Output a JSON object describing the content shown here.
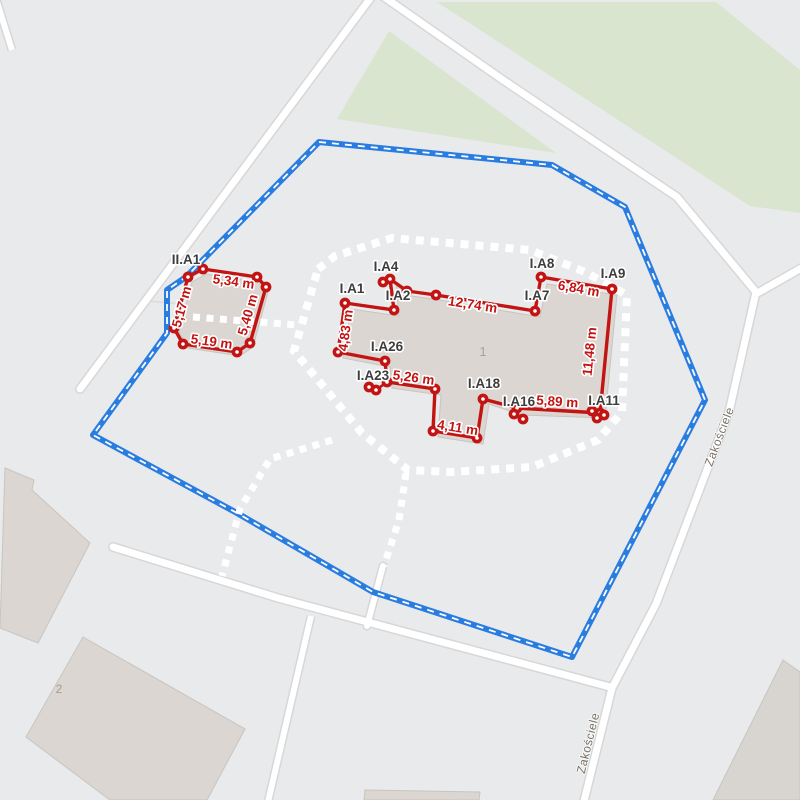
{
  "map": {
    "street": {
      "name": "Zakościele"
    },
    "building_numbers": {
      "main": "1",
      "secondary": "2"
    },
    "colors": {
      "background": "#e9eaec",
      "boundary_blue": "#2a7de0",
      "measure_red": "#c31414",
      "green_area": "#d9e5cf",
      "building_fill": "#dbd6d1",
      "road_fill": "#ffffff",
      "road_casing": "#d7d7d7",
      "guide_white": "#ffffff"
    },
    "vertex_labels": [
      "II.A1",
      "I.A1",
      "I.A2",
      "I.A4",
      "I.A26",
      "I.A23",
      "I.A18",
      "I.A16",
      "I.A11",
      "I.A9",
      "I.A8",
      "I.A7"
    ],
    "measurements": [
      "5,34 m",
      "5,40 m",
      "5,19 m",
      "5,17 m",
      "4,83 m",
      "12,74 m",
      "6,84 m",
      "11,48 m",
      "5,89 m",
      "4,11 m",
      "5,26 m"
    ]
  }
}
